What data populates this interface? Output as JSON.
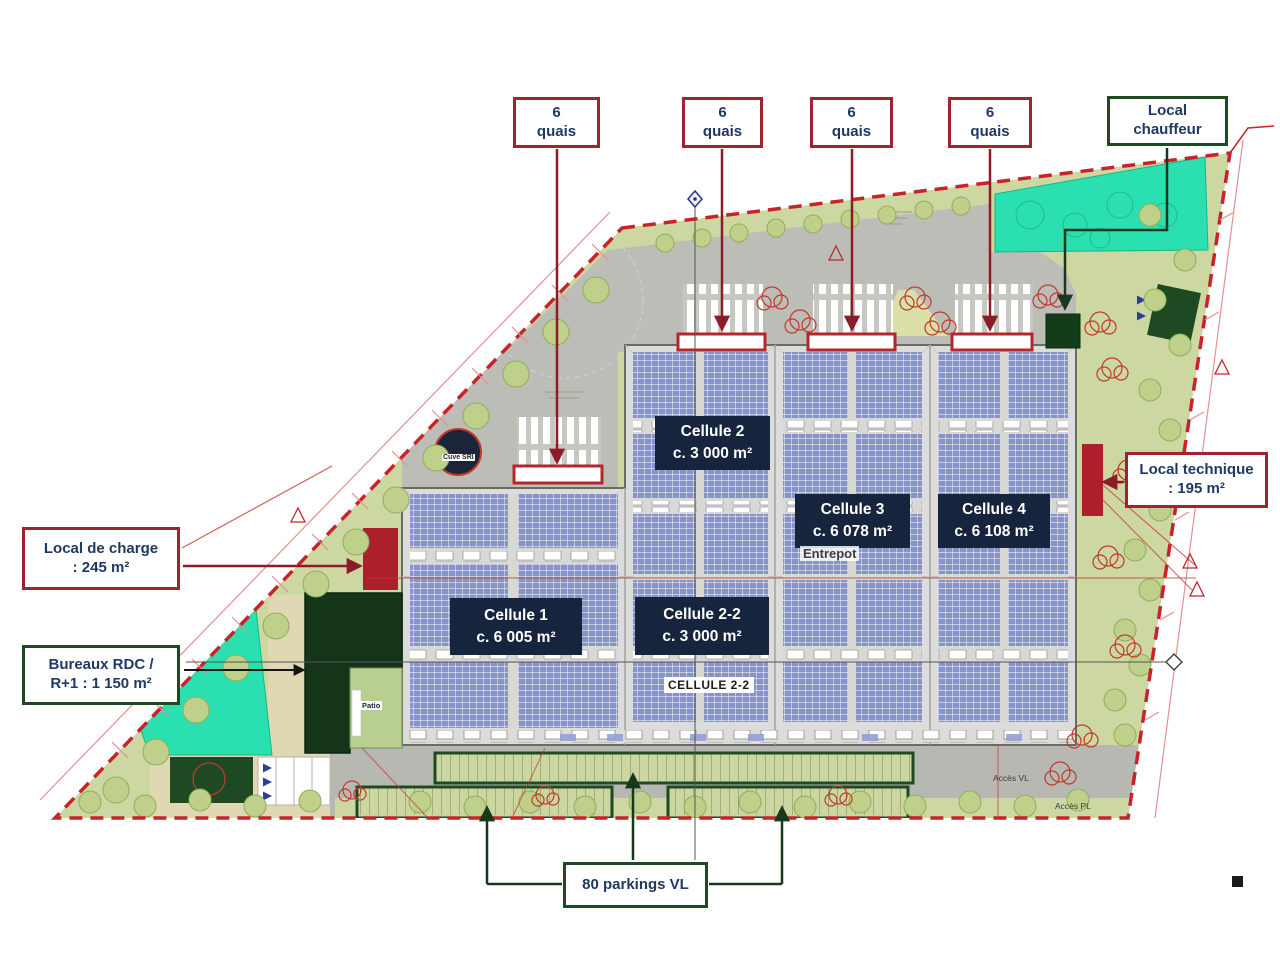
{
  "colors": {
    "red_annotation": "#9e2430",
    "green_annotation": "#1e4922",
    "navy_label_bg": "#16243e",
    "navy_text": "#1f3864",
    "panel_blue": "#8894c9",
    "water_turquoise": "#2ae0b0",
    "boundary_red": "#c8232b"
  },
  "annotations": {
    "quais": {
      "value": "6",
      "unit": "quais"
    },
    "local_chauffeur": {
      "line1": "Local",
      "line2": "chauffeur"
    },
    "local_technique": {
      "line1": "Local technique",
      "line2": ": 195 m²"
    },
    "local_de_charge": {
      "line1": "Local de charge",
      "line2": ": 245 m²"
    },
    "bureaux": {
      "line1": "Bureaux RDC /",
      "line2": "R+1 : 1 150 m²"
    },
    "parkings": {
      "label": "80 parkings VL"
    }
  },
  "cells": {
    "c1": {
      "name": "Cellule 1",
      "area": "c. 6 005 m²"
    },
    "c2": {
      "name": "Cellule 2",
      "area": "c. 3 000 m²"
    },
    "c22": {
      "name": "Cellule 2-2",
      "area": "c. 3 000 m²"
    },
    "c3": {
      "name": "Cellule 3",
      "area": "c. 6 078 m²"
    },
    "c4": {
      "name": "Cellule 4",
      "area": "c. 6 108 m²"
    }
  },
  "plan_texts": {
    "entrepot": "Entrepot",
    "cellule22_floor": "CELLULE 2-2",
    "cuve_sri": "Cuve SRI",
    "acces_vl": "Accès VL",
    "acces_pl": "Accès PL",
    "patio": "Patio"
  }
}
